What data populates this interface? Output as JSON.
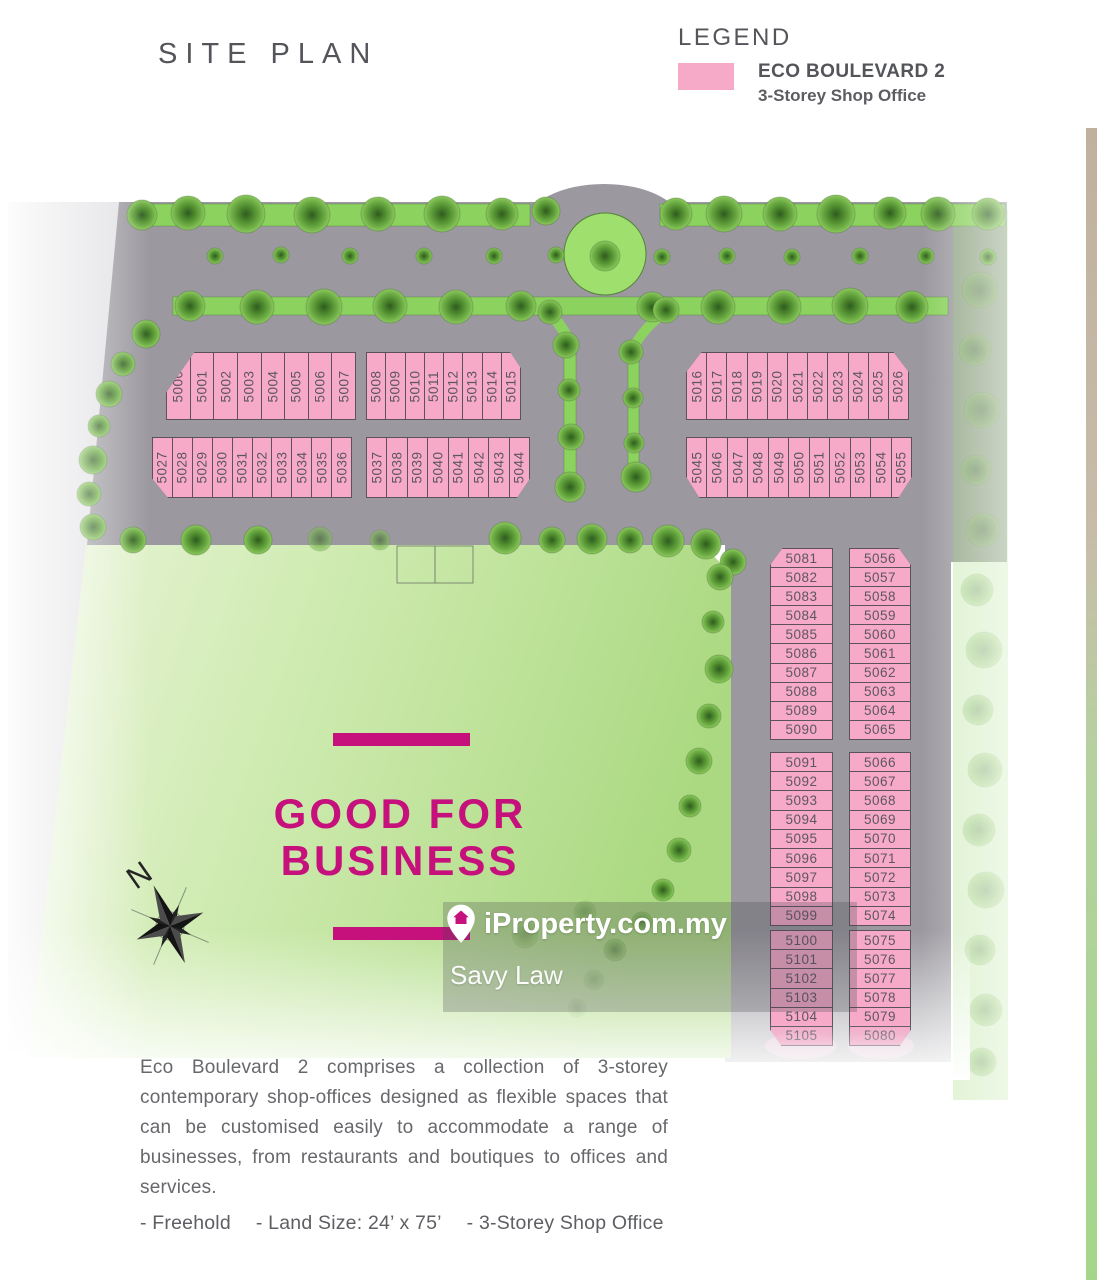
{
  "header": {
    "title": "SITE PLAN"
  },
  "legend": {
    "title": "LEGEND",
    "item_title": "ECO BOULEVARD 2",
    "item_subtitle": "3-Storey Shop Office"
  },
  "site_plan": {
    "tagline_line1": "GOOD FOR",
    "tagline_line2": "BUSINESS",
    "compass_label": "N",
    "lots": {
      "block_a": [
        "5000",
        "5001",
        "5002",
        "5003",
        "5004",
        "5005",
        "5006",
        "5007"
      ],
      "block_b": [
        "5008",
        "5009",
        "5010",
        "5011",
        "5012",
        "5013",
        "5014",
        "5015"
      ],
      "block_c": [
        "5016",
        "5017",
        "5018",
        "5019",
        "5020",
        "5021",
        "5022",
        "5023",
        "5024",
        "5025",
        "5026"
      ],
      "block_d": [
        "5027",
        "5028",
        "5029",
        "5030",
        "5031",
        "5032",
        "5033",
        "5034",
        "5035",
        "5036"
      ],
      "block_e": [
        "5037",
        "5038",
        "5039",
        "5040",
        "5041",
        "5042",
        "5043",
        "5044"
      ],
      "block_f": [
        "5045",
        "5046",
        "5047",
        "5048",
        "5049",
        "5050",
        "5051",
        "5052",
        "5053",
        "5054",
        "5055"
      ],
      "col_left_1": [
        "5081",
        "5082",
        "5083",
        "5084",
        "5085",
        "5086",
        "5087",
        "5088",
        "5089",
        "5090"
      ],
      "col_right_1": [
        "5056",
        "5057",
        "5058",
        "5059",
        "5060",
        "5061",
        "5062",
        "5063",
        "5064",
        "5065"
      ],
      "col_left_2": [
        "5091",
        "5092",
        "5093",
        "5094",
        "5095",
        "5096",
        "5097",
        "5098",
        "5099"
      ],
      "col_right_2": [
        "5066",
        "5067",
        "5068",
        "5069",
        "5070",
        "5071",
        "5072",
        "5073",
        "5074"
      ],
      "col_left_3": [
        "5100",
        "5101",
        "5102",
        "5103",
        "5104",
        "5105"
      ],
      "col_right_3": [
        "5075",
        "5076",
        "5077",
        "5078",
        "5079",
        "5080"
      ]
    }
  },
  "watermark": {
    "brand": "iProperty.com.my",
    "agent": "Savy Law"
  },
  "description": "Eco Boulevard 2 comprises a collection of 3-storey contemporary shop-offices designed as flexible spaces that can be customised easily to accommodate a range of businesses, from restaurants and boutiques to offices and services.",
  "specs": [
    "- Freehold",
    "- Land Size: 24’ x 75’",
    "- 3-Storey Shop Office"
  ],
  "colors": {
    "accent": "#c6107c",
    "lot_pink": "#f7a9c8",
    "road_gray": "#9b999f",
    "strip_green": "#8bd25e",
    "field_green": "#bfe398"
  }
}
